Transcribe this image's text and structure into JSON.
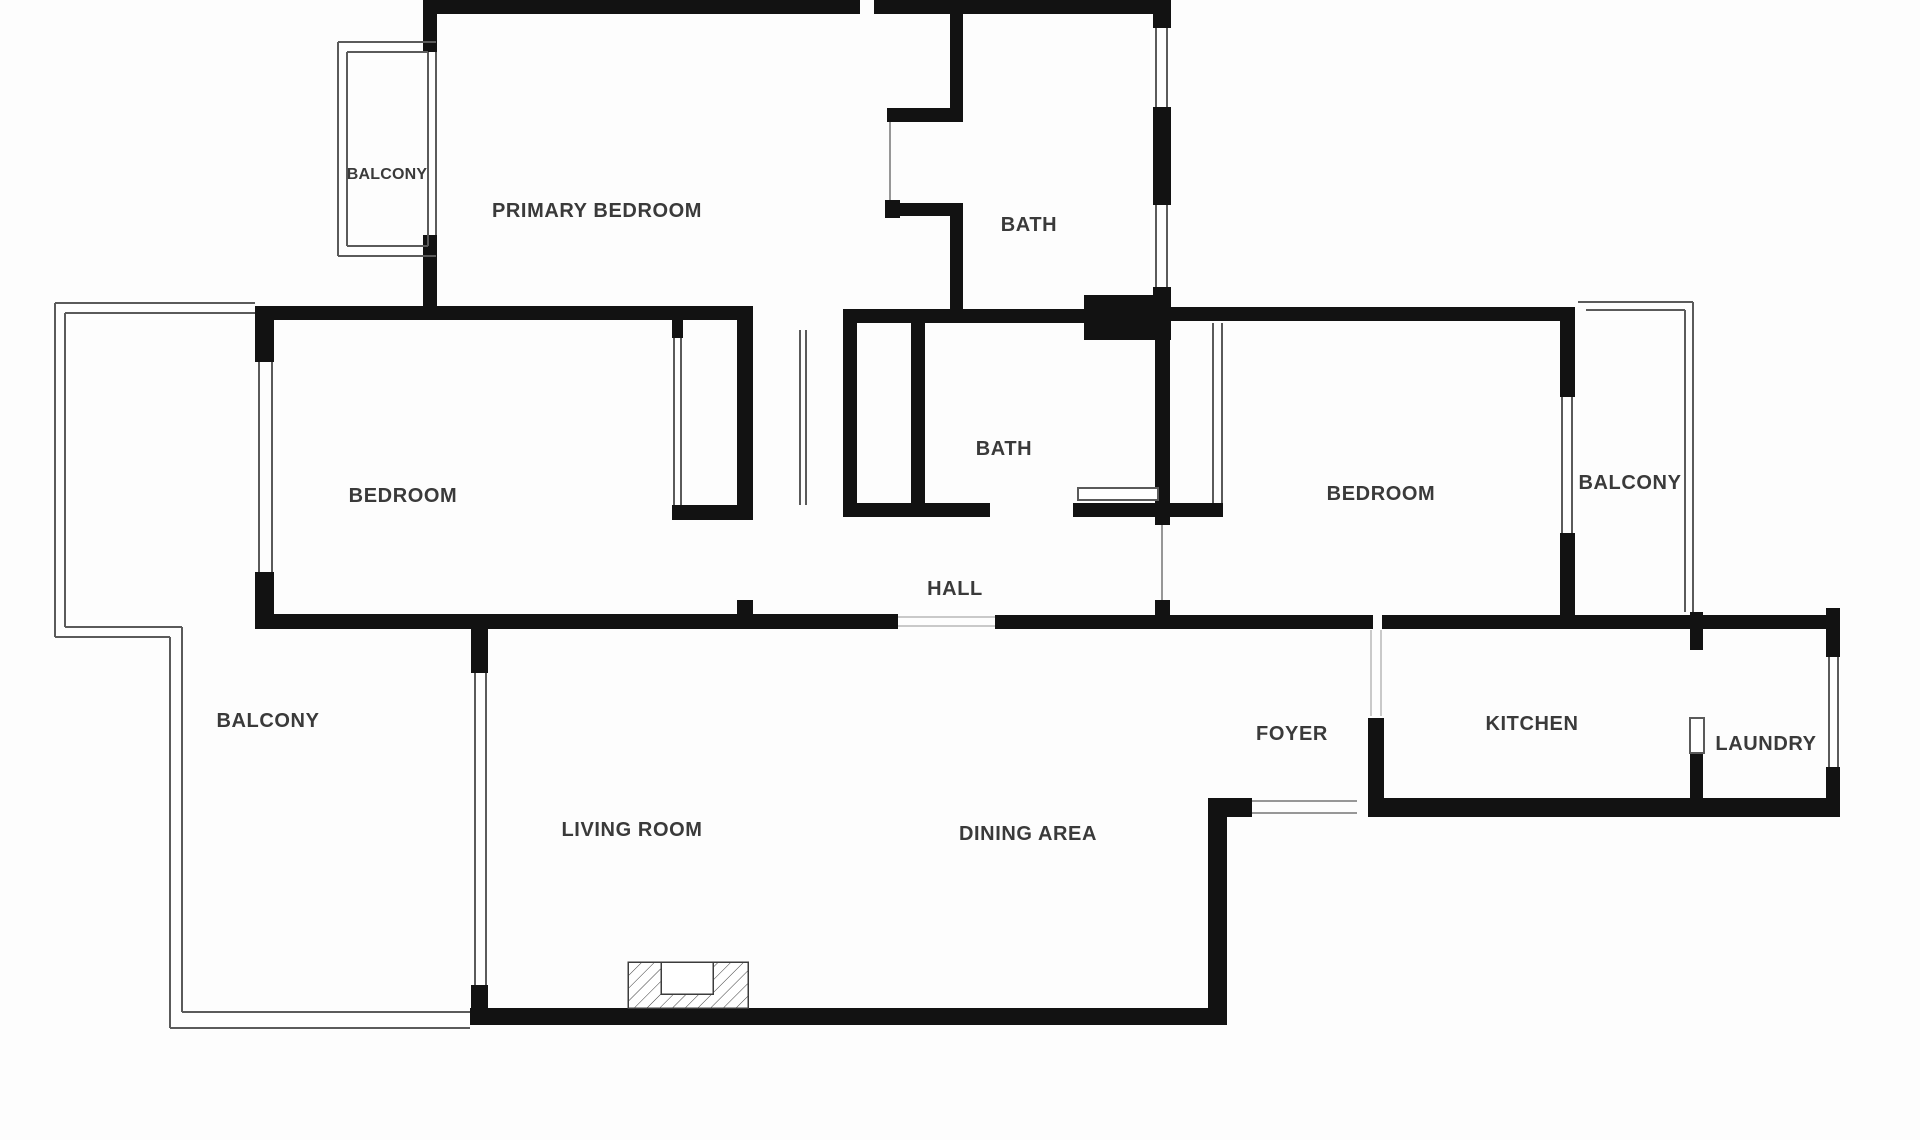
{
  "document": {
    "type": "apartment-floor-plan"
  },
  "colors": {
    "wall": "#121212",
    "background": "#fdfdfd",
    "thin_line": "#5a5a5a",
    "light_line": "#979797",
    "faint_line": "#c9c9c9",
    "label": "#3a3a3a",
    "hatch": "#3c3c3c"
  },
  "rooms": [
    {
      "id": "balcony-top-left",
      "label": "BALCONY"
    },
    {
      "id": "primary-bedroom",
      "label": "PRIMARY BEDROOM"
    },
    {
      "id": "bath-top",
      "label": "BATH"
    },
    {
      "id": "bedroom-left",
      "label": "BEDROOM"
    },
    {
      "id": "bath-middle",
      "label": "BATH"
    },
    {
      "id": "bedroom-right",
      "label": "BEDROOM"
    },
    {
      "id": "balcony-right",
      "label": "BALCONY"
    },
    {
      "id": "hall",
      "label": "HALL"
    },
    {
      "id": "balcony-left",
      "label": "BALCONY"
    },
    {
      "id": "foyer",
      "label": "FOYER"
    },
    {
      "id": "kitchen",
      "label": "KITCHEN"
    },
    {
      "id": "laundry",
      "label": "LAUNDRY"
    },
    {
      "id": "living-room",
      "label": "LIVING ROOM"
    },
    {
      "id": "dining-area",
      "label": "DINING AREA"
    }
  ]
}
